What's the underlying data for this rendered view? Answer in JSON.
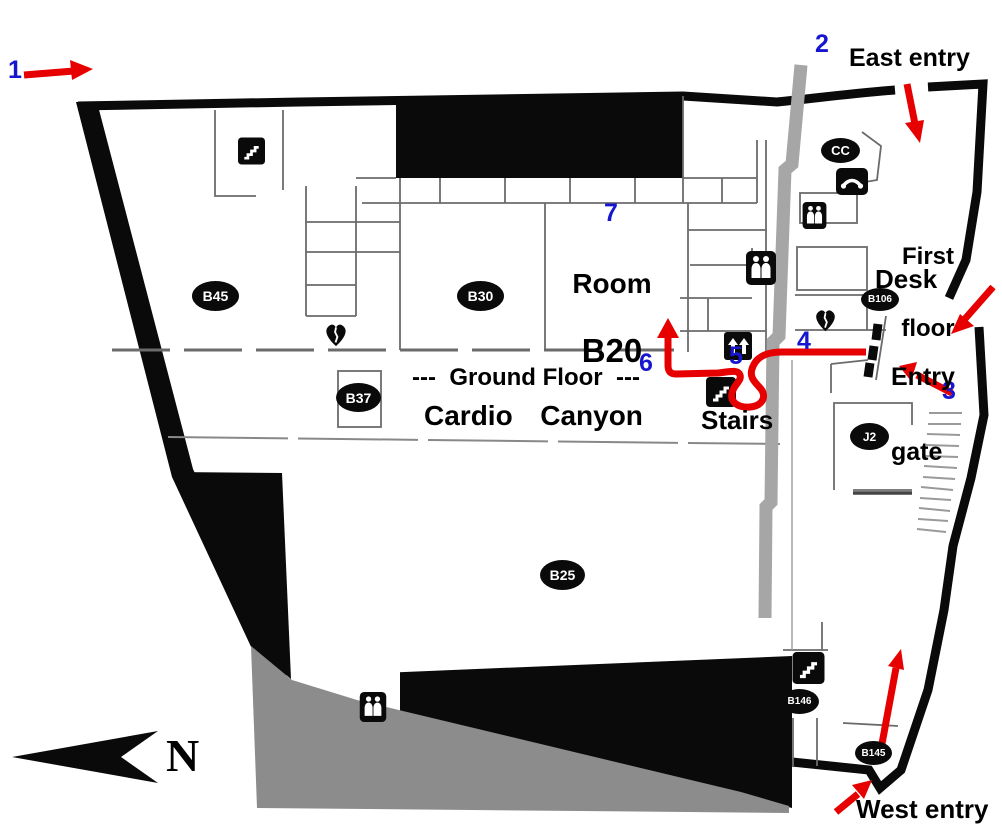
{
  "map": {
    "title": "Cardio Canyon ground-floor route map",
    "labels": {
      "east_entry": "East entry",
      "west_entry": "West entry",
      "first_floor_line1": "First",
      "first_floor_line2": "floor",
      "desk": "Desk",
      "entry_gate_line1": "Entry",
      "entry_gate_line2": "gate",
      "room_b20_line1": "Room",
      "room_b20_line2": "B20",
      "ground_floor": "---  Ground Floor  ---",
      "hall_name": "Cardio  Canyon",
      "stairs": "Stairs",
      "north": "N"
    },
    "route_markers": [
      "1",
      "2",
      "3",
      "4",
      "5",
      "6",
      "7"
    ],
    "room_tags": [
      {
        "label": "B45"
      },
      {
        "label": "B30"
      },
      {
        "label": "B37"
      },
      {
        "label": "B25"
      },
      {
        "label": "B106"
      },
      {
        "label": "CC"
      },
      {
        "label": "J2"
      },
      {
        "label": "B146"
      },
      {
        "label": "B145"
      }
    ],
    "icons": {
      "stairs-icon": "black square with white step zigzag",
      "restroom-icon": "black square with two white figures",
      "phone-icon": "black square with white handset",
      "elevator-icon": "black square with two white up arrows",
      "aed-heart-icon": "black heart with white pulse slit",
      "entry-gate-dashes": "three black dashes (turnstile gate)",
      "north-compass-icon": "black swallow-tail arrow pointing left",
      "route-arrow": "red path with arrowheads"
    },
    "colors": {
      "route_red": "#e60000",
      "marker_blue": "#1616cf",
      "wall_black": "#0a0a0a",
      "corridor_gray": "#a6a6a6",
      "ground_gray": "#8c8c8c"
    }
  }
}
